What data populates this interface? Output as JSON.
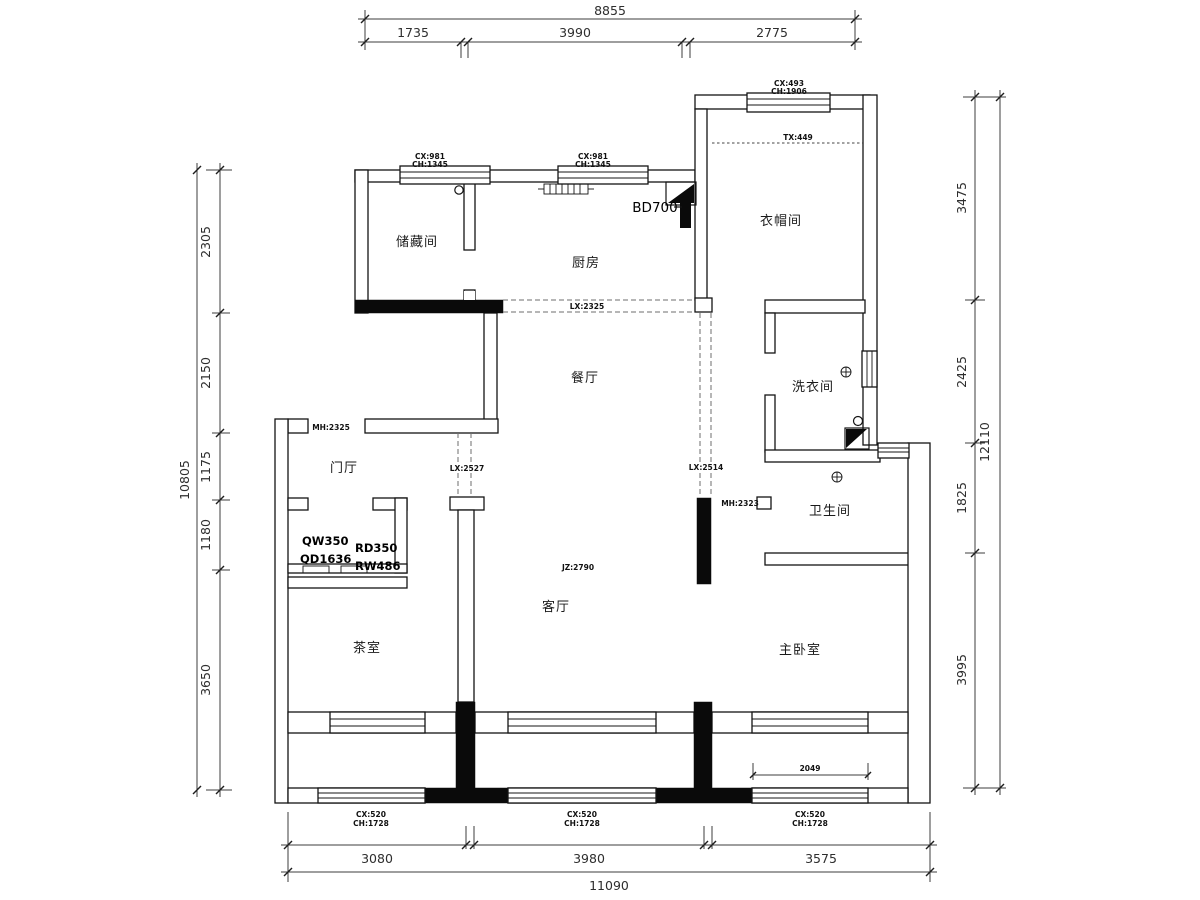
{
  "colors": {
    "line": "#141414",
    "dim": "#3c3c3c",
    "dash": "#6e6e6e",
    "background": "#ffffff"
  },
  "rooms": {
    "storage": "储藏间",
    "kitchen": "厨房",
    "cloakroom": "衣帽间",
    "laundry": "洗衣间",
    "bathroom": "卫生间",
    "foyer": "门厅",
    "dining": "餐厅",
    "living": "客厅",
    "tea_room": "茶室",
    "master_bedroom": "主卧室"
  },
  "dims": {
    "top": {
      "total": "8855",
      "s1": "1735",
      "s2": "3990",
      "s3": "2775"
    },
    "bottom": {
      "total": "11090",
      "s1": "3080",
      "s2": "3980",
      "s3": "3575"
    },
    "left": {
      "total": "10805",
      "s1": "2305",
      "s2": "2150",
      "s3": "1175",
      "s4": "1180",
      "s5": "3650"
    },
    "right": {
      "total": "12110",
      "s1": "3475",
      "s2": "2425",
      "s3": "1825",
      "s4": "3995"
    },
    "balcony_window": "2049"
  },
  "windows": {
    "kitchen_left": {
      "cx": "CX:981",
      "ch": "CH:1345"
    },
    "kitchen_right": {
      "cx": "CX:981",
      "ch": "CH:1345"
    },
    "cloakroom": {
      "cx": "CX:493",
      "ch": "CH:1906"
    },
    "balcony_left": {
      "cx": "CX:520",
      "ch": "CH:1728"
    },
    "balcony_middle": {
      "cx": "CX:520",
      "ch": "CH:1728"
    },
    "balcony_right": {
      "cx": "CX:520",
      "ch": "CH:1728"
    }
  },
  "openings": {
    "kitchen_pass": "LX:2325",
    "foyer_pass": "LX:2527",
    "hall_pass": "LX:2514",
    "cloak_soffit": "TX:449",
    "entry_door": "MH:2325",
    "bath_door": "MH:2323",
    "living_height": "JZ:2790",
    "appliance": "BD700"
  },
  "closet": {
    "qw": "QW350",
    "qd": "QD1636",
    "rd": "RD350",
    "rw": "RW486"
  }
}
